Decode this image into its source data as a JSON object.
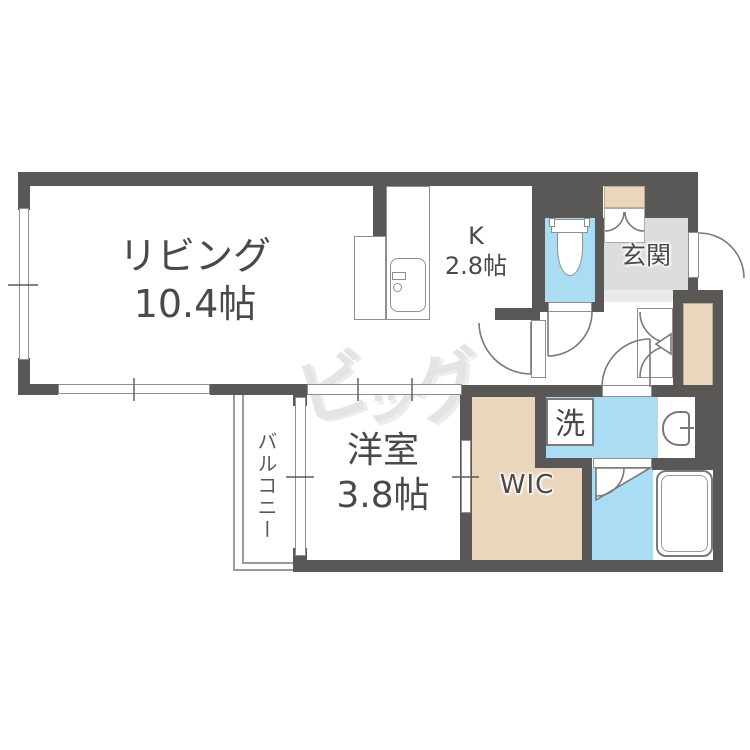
{
  "floorplan": {
    "rooms": {
      "living": {
        "name": "リビング",
        "size": "10.4帖"
      },
      "kitchen": {
        "name": "K",
        "size": "2.8帖"
      },
      "western": {
        "name": "洋室",
        "size": "3.8帖"
      },
      "entrance": {
        "label": "玄関"
      },
      "wic": {
        "label": "WIC"
      },
      "laundry": {
        "label": "洗"
      },
      "balcony": {
        "label": "バルコニー"
      }
    },
    "watermark": {
      "text": "ビッグ",
      "chars": [
        "ビ",
        "ッ",
        "グ"
      ]
    },
    "icons": [
      "toilet-icon",
      "kitchen-sink-icon",
      "washbasin-icon",
      "bathtub-icon",
      "folding-door-icon",
      "door-swing-icons"
    ],
    "colors": {
      "wall": "#5a5857",
      "water_area": "#aadcf4",
      "storage": "#e9d6bd",
      "entrance_floor": "#dcdddd",
      "watermark": "#e6e4e2"
    }
  }
}
